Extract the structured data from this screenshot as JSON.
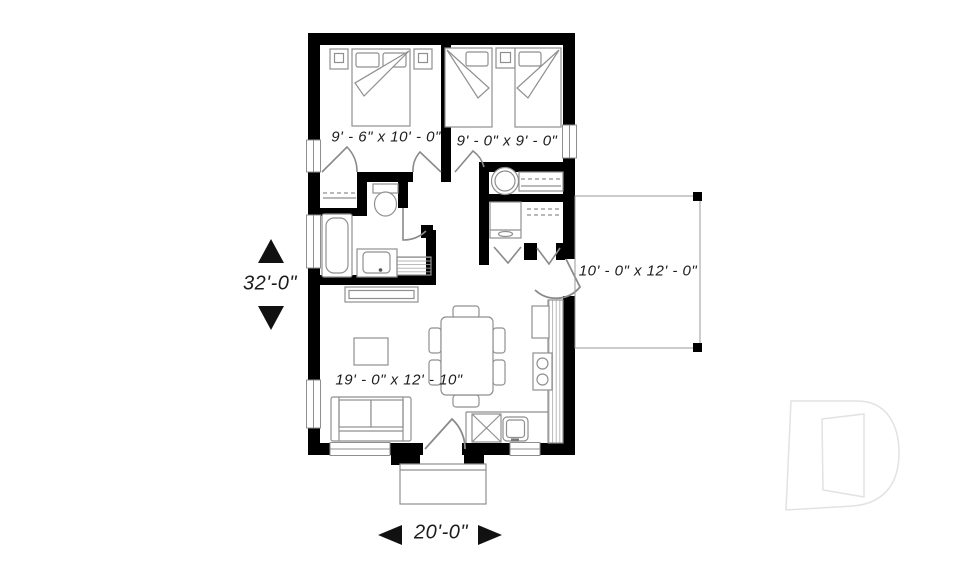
{
  "plan": {
    "rooms": {
      "bedroom1": {
        "dimensions": "9' - 6\" x 10' - 0\""
      },
      "bedroom2": {
        "dimensions": "9' - 0\" x 9' - 0\""
      },
      "living": {
        "dimensions": "19' - 0\" x 12' - 10\""
      },
      "patio": {
        "dimensions": "10' - 0\" x 12' - 0\""
      }
    },
    "overall": {
      "height": "32'-0\"",
      "width": "20'-0\""
    },
    "icons": [
      "double-bed",
      "twin-bed",
      "nightstand",
      "bathtub",
      "toilet",
      "vanity-sink",
      "washer",
      "dresser",
      "refrigerator",
      "stove",
      "dishwasher",
      "kitchen-sink",
      "sofa",
      "coffee-table",
      "dining-table",
      "dining-chair",
      "door-swing",
      "bifold-door",
      "window",
      "stoop",
      "dimension-arrow",
      "drummond-logo"
    ],
    "colors": {
      "wall": "#000000",
      "furniture_line": "#8f8f8f",
      "text": "#1c1c1c",
      "logo_outline": "#e2e2e2"
    }
  }
}
